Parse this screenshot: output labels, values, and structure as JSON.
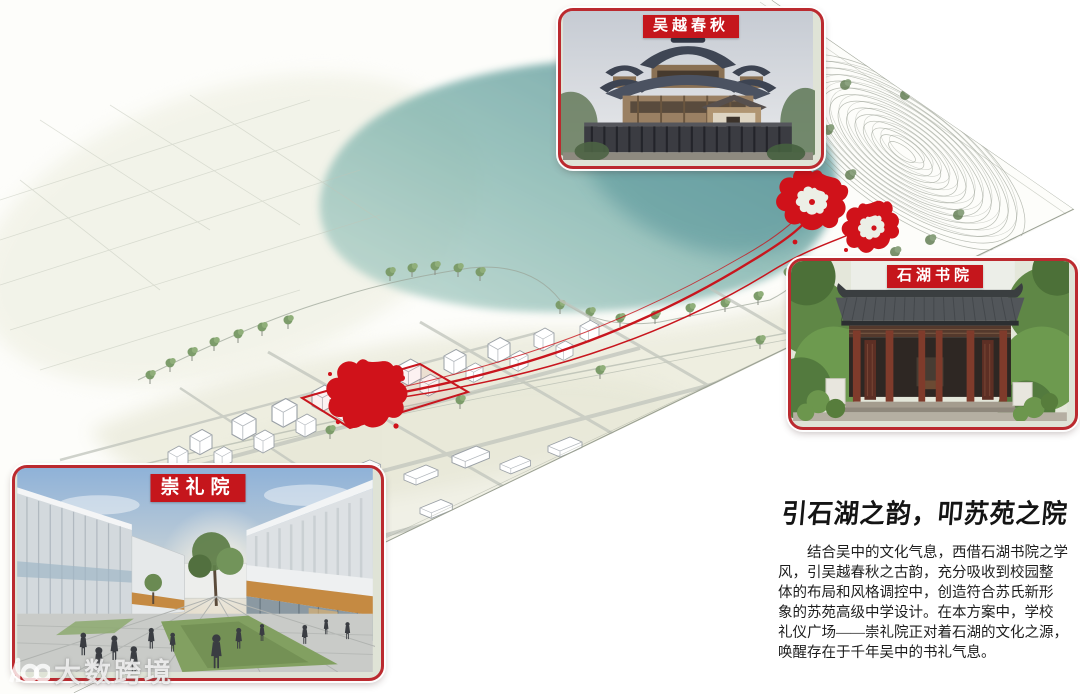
{
  "cards": [
    {
      "id": "wuyue",
      "label": "吴越春秋"
    },
    {
      "id": "shihu",
      "label": "石湖书院"
    },
    {
      "id": "chongli",
      "label": "崇礼院"
    }
  ],
  "text_block": {
    "title": "引石湖之韵，叩苏苑之院",
    "body_lines": [
      "结合吴中的文化气息，西借石湖书院之学",
      "风，引吴越春秋之古韵，充分吸收到校园整",
      "体的布局和风格调控中，创造符合苏氏新形",
      "象的苏苑高级中学设计。在本方案中，学校",
      "礼仪广场——崇礼院正对着石湖的文化之源，",
      "唤醒存在于千年吴中的书礼气息。"
    ]
  },
  "watermark": {
    "text": "大数跨境",
    "icon": "infinity-100-logo"
  },
  "map": {
    "markers": [
      "site-seal-marker",
      "wuyue-seal-marker",
      "shihu-seal-marker"
    ],
    "features": [
      "lake",
      "shoreline-trees",
      "axon-city-blocks",
      "contour-hill",
      "red-connection-lines",
      "site-outline"
    ]
  },
  "colors": {
    "accent_red": "#bb2a2f",
    "label_red": "#c5161c",
    "seal_red": "#d0121a",
    "lake_teal": "#5f9a9c",
    "land_green": "#dcdcc2"
  }
}
